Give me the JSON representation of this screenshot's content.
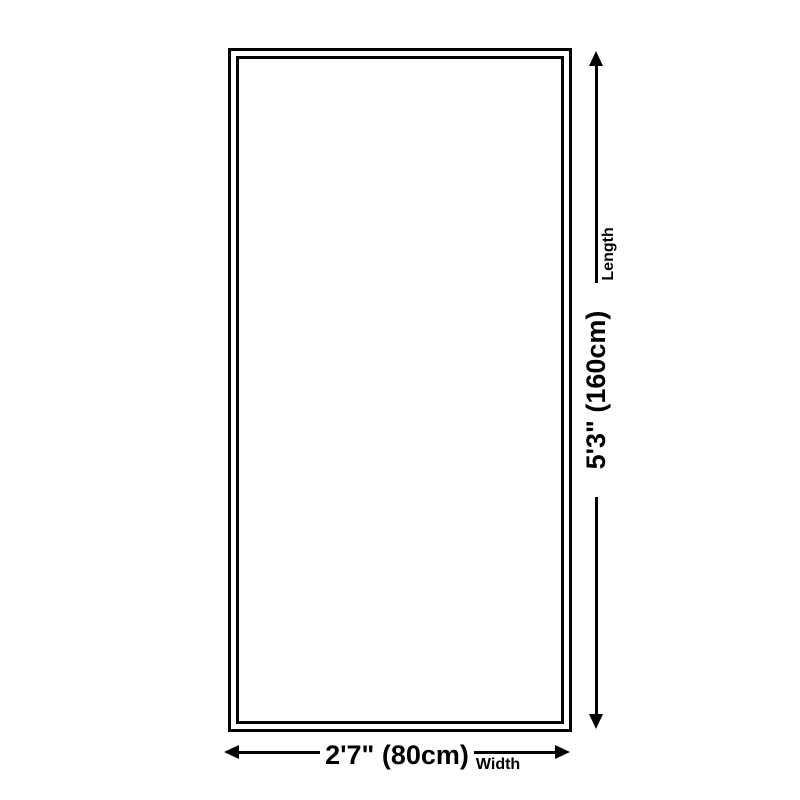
{
  "diagram": {
    "type": "product-dimension-diagram",
    "shape": "rectangle",
    "background_color": "#ffffff",
    "line_color": "#000000"
  },
  "dimensions": {
    "length": {
      "value": "5'3\" (160cm)",
      "label": "Length"
    },
    "width": {
      "value": "2'7\" (80cm)",
      "label": "Width"
    }
  }
}
